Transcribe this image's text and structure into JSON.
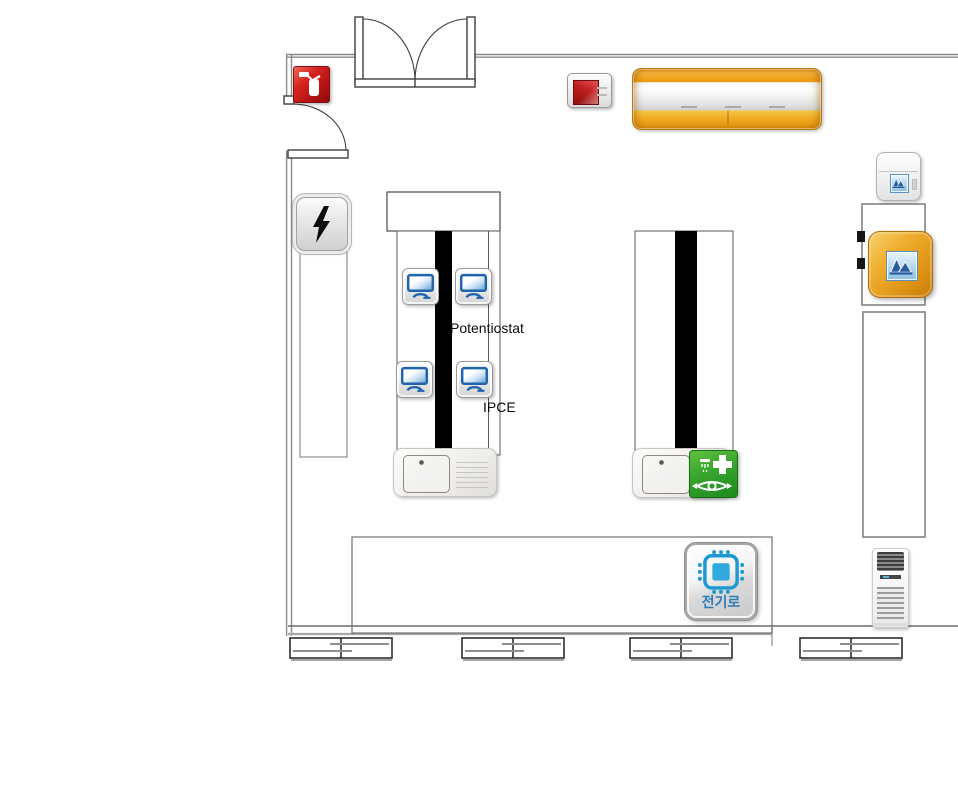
{
  "scene": {
    "kind": "laboratory-floorplan"
  },
  "labels": {
    "potentiostat": "Potentiostat",
    "ipce": "IPCE"
  },
  "furnace_button": {
    "label": "전기로"
  },
  "monitors": {
    "count": 4
  },
  "colors": {
    "wall_gray": "#8a8a8a",
    "extinguisher_red": "#c41616",
    "emergency_red": "#b81c1c",
    "cabinet_orange": "#eea21d",
    "instrument_orange": "#e8a32a",
    "eyewash_green": "#2f9e2a",
    "monitor_blue": "#2263ad",
    "chip_blue": "#1b9ad2",
    "furnace_label_blue": "#2e7cb8",
    "bench_stripe_black": "#000000"
  },
  "icons": {
    "fire_extinguisher": "fire-extinguisher-icon",
    "emergency_stop": "emergency-stop-icon",
    "safety_cabinet": "safety-cabinet",
    "electrical_panel": "lightning-icon",
    "workstation": "monitor-icon",
    "sink": "sink-basin",
    "eyewash": "eyewash-station-icon",
    "furnace": "chip-icon",
    "analyzer": "spectrum-peaks-icon",
    "air_conditioner": "floor-ac-unit"
  }
}
